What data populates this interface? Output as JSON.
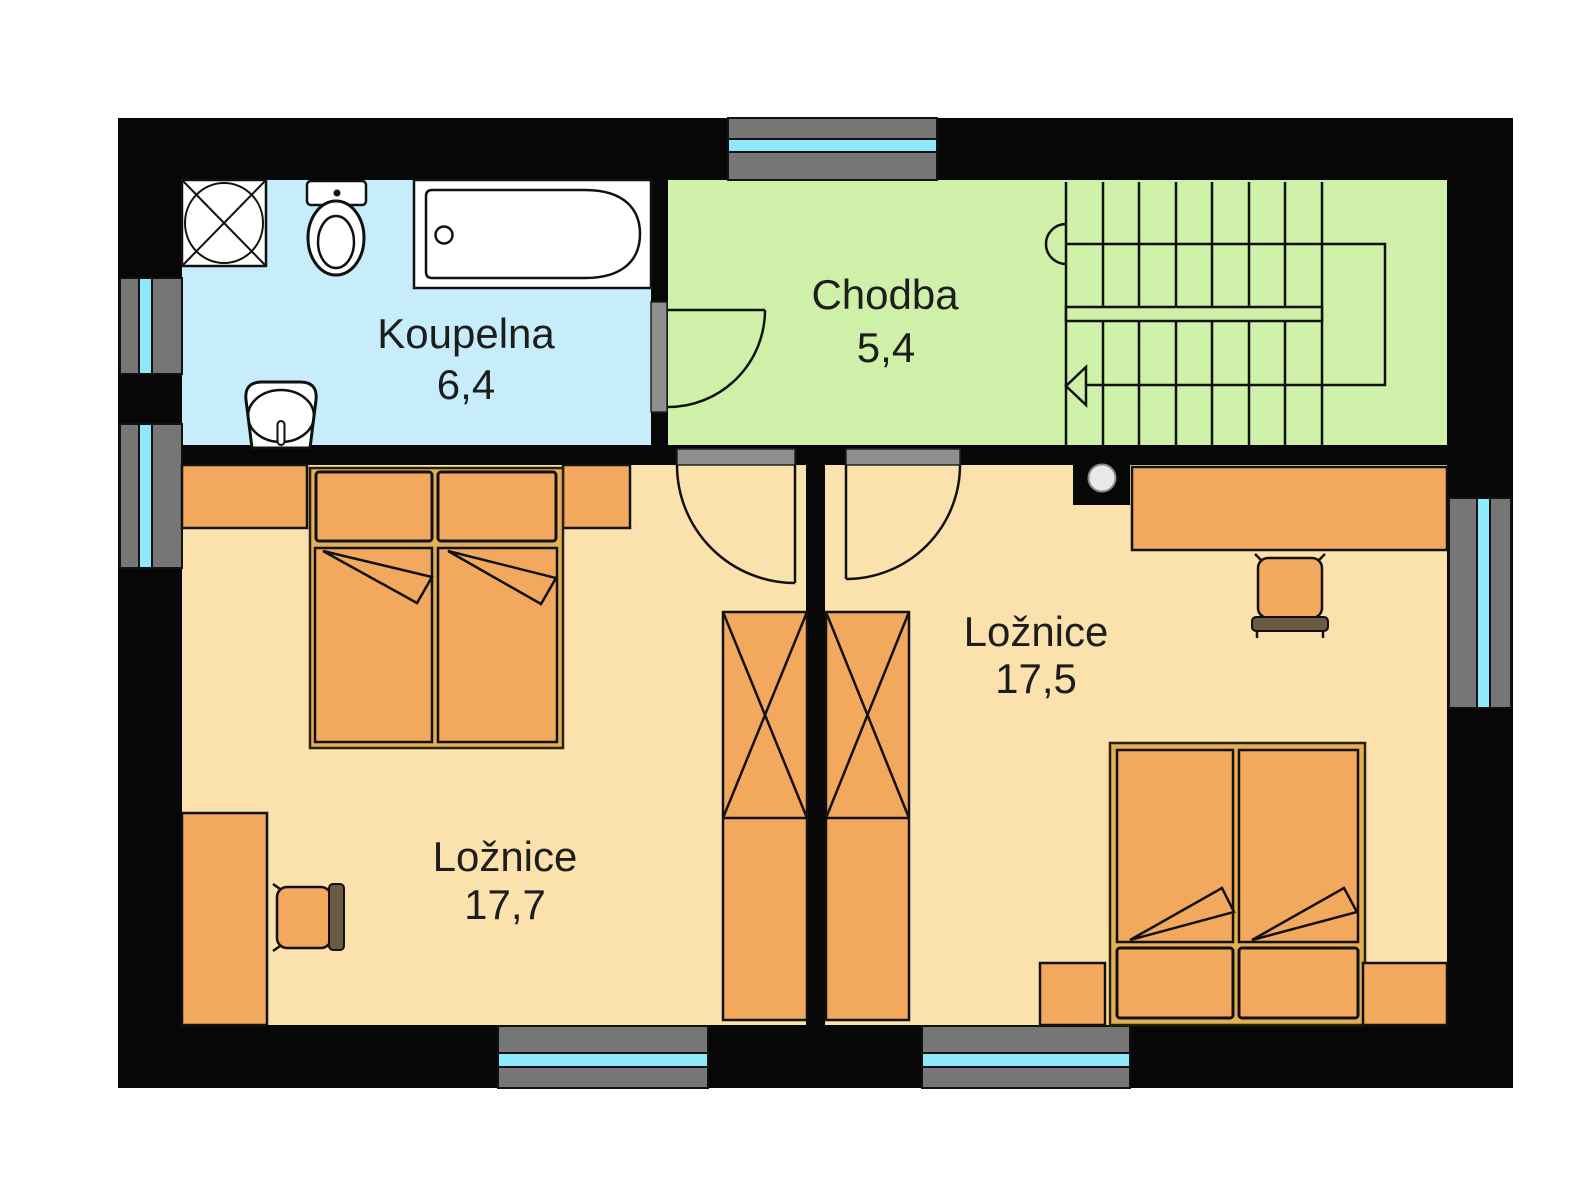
{
  "floorplan": {
    "rooms": [
      {
        "name": "Koupelna",
        "area": "6,4"
      },
      {
        "name": "Chodba",
        "area": "5,4"
      },
      {
        "name": "Ložnice",
        "area": "17,7"
      },
      {
        "name": "Ložnice",
        "area": "17,5"
      }
    ],
    "colors": {
      "bathroom_floor": "#c8edfa",
      "hallway_floor": "#cff0a8",
      "bedroom_floor": "#fbe2ad",
      "furniture": "#f3a95d",
      "bed_frame": "#e2af52",
      "wall": "#070707",
      "window_frame": "#767676",
      "window_glass": "#8ee9fb",
      "threshold_gray": "#8f8f8f"
    },
    "fixtures": [
      "shower",
      "toilet",
      "bathtub",
      "sink",
      "staircase",
      "chimney"
    ],
    "furniture": [
      "double-bed",
      "pillow",
      "nightstand",
      "dresser",
      "desk",
      "chair",
      "wardrobe"
    ]
  }
}
